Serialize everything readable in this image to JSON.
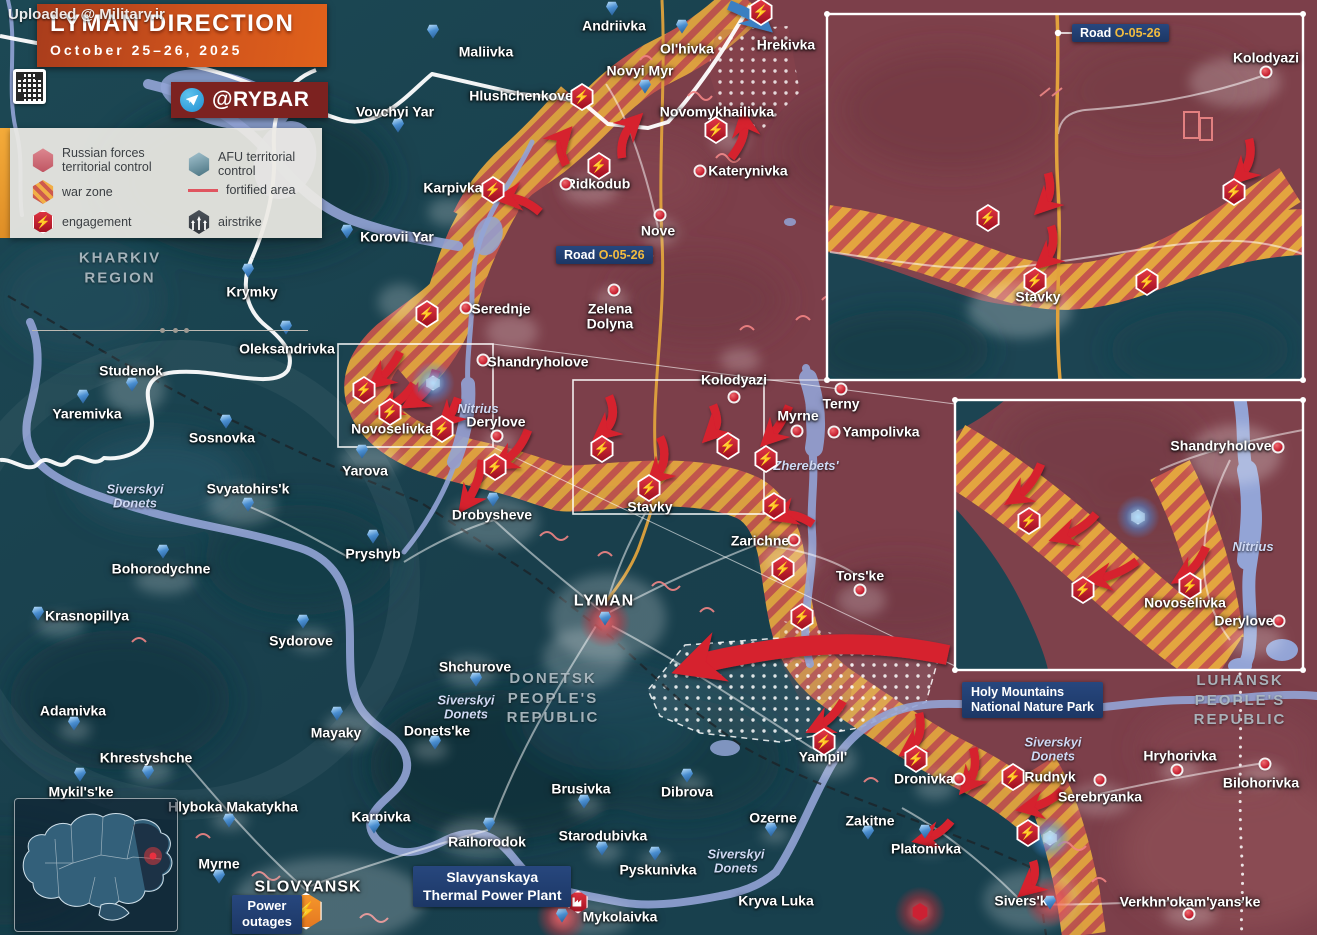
{
  "watermark": "Uploaded @ Military.ir",
  "header": {
    "title": "LYMAN DIRECTION",
    "date": "October 25–26, 2025",
    "handle": "@RYBAR"
  },
  "legend": {
    "russian": "Russian forces territorial control",
    "afu": "AFU territorial control",
    "warzone": "war zone",
    "fortified": "fortified area",
    "engagement": "engagement",
    "airstrike": "airstrike"
  },
  "badges": {
    "road_main": {
      "prefix": "Road",
      "code": "O-05-26"
    },
    "road_inset": {
      "prefix": "Road",
      "code": "O-05-26"
    },
    "holy": {
      "l1": "Holy Mountains",
      "l2": "National Nature Park"
    },
    "tpp": {
      "l1": "Slavyanskaya",
      "l2": "Thermal Power Plant"
    },
    "outage": {
      "l1": "Power",
      "l2": "outages"
    }
  },
  "icons": {
    "bolt": "⚡"
  },
  "regions": [
    {
      "t": "KHARKIV\nREGION",
      "x": 120,
      "y": 268
    },
    {
      "t": "DONETSK\nPEOPLE'S\nREPUBLIC",
      "x": 553,
      "y": 698
    },
    {
      "t": "LUHANSK\nPEOPLE'S\nREPUBLIC",
      "x": 1240,
      "y": 700
    }
  ],
  "rivers": [
    {
      "t": "Siverskyi\nDonets",
      "x": 135,
      "y": 497
    },
    {
      "t": "Siverskyi\nDonets",
      "x": 466,
      "y": 708
    },
    {
      "t": "Siverskyi\nDonets",
      "x": 736,
      "y": 862
    },
    {
      "t": "Siverskyi\nDonets",
      "x": 1053,
      "y": 750
    },
    {
      "t": "Nitrius",
      "x": 478,
      "y": 409
    },
    {
      "t": "Zherebets'",
      "x": 806,
      "y": 466
    },
    {
      "t": "Nitrius",
      "x": 1253,
      "y": 547
    }
  ],
  "settlements": [
    {
      "n": "Andriivka",
      "x": 614,
      "y": 26,
      "m": "b",
      "mx": 612,
      "my": 10
    },
    {
      "n": "Maliivka",
      "x": 486,
      "y": 52,
      "m": "b",
      "mx": 433,
      "my": 33
    },
    {
      "n": "Ol'hivka",
      "x": 687,
      "y": 49,
      "m": "b",
      "mx": 682,
      "my": 28
    },
    {
      "n": "Novyi Myr",
      "x": 640,
      "y": 71,
      "m": "b",
      "mx": 645,
      "my": 88
    },
    {
      "n": "Hrekivka",
      "x": 786,
      "y": 45
    },
    {
      "n": "Novomykhailivka",
      "x": 717,
      "y": 112
    },
    {
      "n": "Hlushchenkove",
      "x": 521,
      "y": 96
    },
    {
      "n": "Katerynivka",
      "x": 748,
      "y": 171,
      "m": "r",
      "mx": 700,
      "my": 171
    },
    {
      "n": "Vovchyi Yar",
      "x": 395,
      "y": 112,
      "m": "b",
      "mx": 398,
      "my": 127
    },
    {
      "n": "Karpivka",
      "x": 453,
      "y": 188
    },
    {
      "n": "Ridkodub",
      "x": 598,
      "y": 184,
      "m": "r",
      "mx": 566,
      "my": 184
    },
    {
      "n": "Nove",
      "x": 658,
      "y": 231,
      "m": "r",
      "mx": 660,
      "my": 215
    },
    {
      "n": "Korovii Yar",
      "x": 397,
      "y": 237,
      "m": "b",
      "mx": 347,
      "my": 233
    },
    {
      "n": "Krymky",
      "x": 252,
      "y": 292,
      "m": "b",
      "mx": 248,
      "my": 272
    },
    {
      "n": "Oleksandrivka",
      "x": 287,
      "y": 349,
      "m": "b",
      "mx": 286,
      "my": 329
    },
    {
      "n": "Studenok",
      "x": 131,
      "y": 371,
      "m": "b",
      "mx": 132,
      "my": 386
    },
    {
      "n": "Yaremivka",
      "x": 87,
      "y": 414,
      "m": "b",
      "mx": 83,
      "my": 398
    },
    {
      "n": "Sosnovka",
      "x": 222,
      "y": 438,
      "m": "b",
      "mx": 226,
      "my": 423
    },
    {
      "n": "Serednje",
      "x": 501,
      "y": 309,
      "m": "r",
      "mx": 466,
      "my": 308
    },
    {
      "n": "Zelena\nDolyna",
      "x": 610,
      "y": 316,
      "m": "r",
      "mx": 614,
      "my": 290
    },
    {
      "n": "Shandryholove",
      "x": 538,
      "y": 362,
      "m": "r",
      "mx": 483,
      "my": 360
    },
    {
      "n": "Kolodyazi",
      "x": 734,
      "y": 380,
      "m": "r",
      "mx": 734,
      "my": 397
    },
    {
      "n": "Novoselivka",
      "x": 392,
      "y": 429
    },
    {
      "n": "Derylove",
      "x": 496,
      "y": 422,
      "m": "r",
      "mx": 497,
      "my": 436
    },
    {
      "n": "Myrne",
      "x": 798,
      "y": 416,
      "m": "r",
      "mx": 797,
      "my": 431
    },
    {
      "n": "Terny",
      "x": 841,
      "y": 404,
      "m": "r",
      "mx": 841,
      "my": 389
    },
    {
      "n": "Yampolivka",
      "x": 881,
      "y": 432,
      "m": "r",
      "mx": 834,
      "my": 432
    },
    {
      "n": "Yarova",
      "x": 365,
      "y": 471,
      "m": "b",
      "mx": 362,
      "my": 453
    },
    {
      "n": "Svyatohirs'k",
      "x": 248,
      "y": 489,
      "m": "b",
      "mx": 248,
      "my": 506
    },
    {
      "n": "Pryshyb",
      "x": 373,
      "y": 554,
      "m": "b",
      "mx": 373,
      "my": 538
    },
    {
      "n": "Drobysheve",
      "x": 492,
      "y": 515,
      "m": "b",
      "mx": 493,
      "my": 501
    },
    {
      "n": "Stavky",
      "x": 650,
      "y": 507
    },
    {
      "n": "Zarichne",
      "x": 760,
      "y": 541,
      "m": "r",
      "mx": 794,
      "my": 540
    },
    {
      "n": "Tors'ke",
      "x": 860,
      "y": 576,
      "m": "r",
      "mx": 860,
      "my": 590
    },
    {
      "n": "LYMAN",
      "x": 604,
      "y": 602,
      "m": "b",
      "mx": 605,
      "my": 620,
      "caps": 1
    },
    {
      "n": "Bohorodychne",
      "x": 161,
      "y": 569,
      "m": "b",
      "mx": 163,
      "my": 553
    },
    {
      "n": "Krasnopillya",
      "x": 87,
      "y": 616,
      "m": "b",
      "mx": 38,
      "my": 615
    },
    {
      "n": "Sydorove",
      "x": 301,
      "y": 641,
      "m": "b",
      "mx": 303,
      "my": 623
    },
    {
      "n": "Shchurove",
      "x": 475,
      "y": 667,
      "m": "b",
      "mx": 476,
      "my": 681
    },
    {
      "n": "Adamivka",
      "x": 73,
      "y": 711,
      "m": "b",
      "mx": 74,
      "my": 725
    },
    {
      "n": "Mayaky",
      "x": 336,
      "y": 733,
      "m": "b",
      "mx": 337,
      "my": 715
    },
    {
      "n": "Donets'ke",
      "x": 437,
      "y": 731,
      "m": "b",
      "mx": 435,
      "my": 744
    },
    {
      "n": "Khrestyshche",
      "x": 146,
      "y": 758,
      "m": "b",
      "mx": 148,
      "my": 774
    },
    {
      "n": "Mykil's'ke",
      "x": 81,
      "y": 792,
      "m": "b",
      "mx": 80,
      "my": 776
    },
    {
      "n": "Hlyboka Makatykha",
      "x": 233,
      "y": 807,
      "m": "b",
      "mx": 229,
      "my": 822
    },
    {
      "n": "Myrne",
      "x": 219,
      "y": 864,
      "m": "b",
      "mx": 219,
      "my": 878
    },
    {
      "n": "Karpivka",
      "x": 381,
      "y": 817,
      "m": "b",
      "mx": 374,
      "my": 828
    },
    {
      "n": "Raihorodok",
      "x": 487,
      "y": 842,
      "m": "b",
      "mx": 489,
      "my": 826
    },
    {
      "n": "Brusivka",
      "x": 581,
      "y": 789,
      "m": "b",
      "mx": 584,
      "my": 803
    },
    {
      "n": "Starodubivka",
      "x": 603,
      "y": 836,
      "m": "b",
      "mx": 602,
      "my": 850
    },
    {
      "n": "Pyskunivka",
      "x": 658,
      "y": 870,
      "m": "b",
      "mx": 655,
      "my": 855
    },
    {
      "n": "Dibrova",
      "x": 687,
      "y": 792,
      "m": "b",
      "mx": 687,
      "my": 777
    },
    {
      "n": "Ozerne",
      "x": 773,
      "y": 818,
      "m": "b",
      "mx": 771,
      "my": 831
    },
    {
      "n": "Kryva Luka",
      "x": 776,
      "y": 901
    },
    {
      "n": "Mykolaivka",
      "x": 620,
      "y": 917,
      "m": "b",
      "mx": 562,
      "my": 917
    },
    {
      "n": "SLOVYANSK",
      "x": 308,
      "y": 888,
      "caps": 1
    },
    {
      "n": "Yampil'",
      "x": 823,
      "y": 757
    },
    {
      "n": "Dronivka",
      "x": 924,
      "y": 779,
      "m": "r",
      "mx": 959,
      "my": 779
    },
    {
      "n": "Rudnyk",
      "x": 1050,
      "y": 777,
      "m": "r",
      "mx": 1100,
      "my": 780
    },
    {
      "n": "Serebryanka",
      "x": 1100,
      "y": 797
    },
    {
      "n": "Zakitne",
      "x": 870,
      "y": 821,
      "m": "b",
      "mx": 868,
      "my": 834
    },
    {
      "n": "Platonivka",
      "x": 926,
      "y": 849,
      "m": "b",
      "mx": 925,
      "my": 833
    },
    {
      "n": "Sivers'k",
      "x": 1021,
      "y": 901,
      "m": "b",
      "mx": 1050,
      "my": 904
    },
    {
      "n": "Hryhorivka",
      "x": 1180,
      "y": 756,
      "m": "r",
      "mx": 1177,
      "my": 770
    },
    {
      "n": "Bilohorivka",
      "x": 1261,
      "y": 783,
      "m": "r",
      "mx": 1265,
      "my": 764
    },
    {
      "n": "Verkhn'okam'yans'ke",
      "x": 1190,
      "y": 902,
      "m": "r",
      "mx": 1189,
      "my": 914
    },
    {
      "n": "Kolodyazi",
      "x": 1266,
      "y": 58,
      "m": "r",
      "mx": 1266,
      "my": 72
    },
    {
      "n": "Stavky",
      "x": 1038,
      "y": 297
    },
    {
      "n": "Shandryholove",
      "x": 1221,
      "y": 446,
      "m": "r",
      "mx": 1278,
      "my": 447
    },
    {
      "n": "Novoselivka",
      "x": 1185,
      "y": 603
    },
    {
      "n": "Derylove",
      "x": 1244,
      "y": 621,
      "m": "r",
      "mx": 1279,
      "my": 621
    }
  ],
  "engagements": [
    [
      582,
      97
    ],
    [
      761,
      12
    ],
    [
      716,
      130
    ],
    [
      493,
      190
    ],
    [
      599,
      166
    ],
    [
      427,
      314
    ],
    [
      364,
      390
    ],
    [
      390,
      412
    ],
    [
      442,
      429
    ],
    [
      495,
      467
    ],
    [
      602,
      449
    ],
    [
      649,
      488
    ],
    [
      728,
      446
    ],
    [
      766,
      459
    ],
    [
      774,
      506
    ],
    [
      783,
      569
    ],
    [
      802,
      617
    ],
    [
      824,
      742
    ],
    [
      916,
      759
    ],
    [
      1013,
      777
    ],
    [
      1028,
      833
    ],
    [
      988,
      218
    ],
    [
      1035,
      281
    ],
    [
      1147,
      282
    ],
    [
      1234,
      192
    ],
    [
      1029,
      521
    ],
    [
      1083,
      590
    ],
    [
      1190,
      586
    ]
  ],
  "glows_blue": [
    [
      433,
      383
    ],
    [
      1138,
      517
    ],
    [
      1050,
      838
    ]
  ],
  "glows_red": [
    {
      "x": 605,
      "y": 622
    },
    {
      "x": 1050,
      "y": 902
    },
    {
      "x": 562,
      "y": 917
    },
    {
      "x": 920,
      "y": 912,
      "solid": 1
    }
  ],
  "arrows_red": [
    "M566,165 C560,152 558,143 564,136",
    "M622,158 C620,144 624,132 634,122",
    "M731,158 C740,146 746,135 744,121",
    "M540,212 C527,201 515,197 506,198",
    "M400,352 C394,364 386,374 377,381",
    "M414,384 C406,396 396,404 386,409",
    "M436,370 C432,384 424,395 412,402",
    "M458,398 C454,410 450,416 446,420",
    "M528,430 C522,446 512,457 501,463",
    "M482,460 C480,478 474,492 466,503",
    "M609,396 C616,412 613,424 602,433",
    "M660,437 C668,453 664,468 655,477",
    "M713,405 C719,420 718,427 711,434",
    "M789,406 C783,420 777,430 769,438",
    "M813,524 C801,516 790,513 781,516",
    "M843,701 C836,713 827,722 817,727",
    "M919,713 C923,729 919,742 909,749",
    "M973,748 C977,762 975,775 967,785",
    "M1062,791 C1051,801 1039,806 1028,808",
    "M951,821 C943,831 933,837 924,839",
    "M1033,861 C1037,873 1034,883 1027,889",
    "M1048,173 C1052,188 1050,199 1043,206",
    "M1051,226 C1056,241 1052,254 1044,261",
    "M1249,139 C1253,154 1249,167 1240,176",
    "M1041,464 C1035,479 1026,491 1015,498",
    "M1096,514 C1087,525 1074,533 1061,537",
    "M1137,561 C1124,571 1109,577 1096,579",
    "M1206,547 C1200,561 1192,571 1182,577"
  ],
  "arrow_big": "M948,655 C878,640 815,642 758,652 C728,657 708,661 696,665",
  "arrow_blue": "M729,5 C743,11 754,16 762,23",
  "colors": {
    "russian_area": "#7c3f4a",
    "afu_area": "#1a4350",
    "warzone_orange": "#eaa842",
    "warzone_red": "#c5564c",
    "arrow_red": "#d6202f",
    "arrow_blue": "#3a7fc1",
    "accent_orange": "#e0611b",
    "badge_navy": "#1c3765"
  }
}
